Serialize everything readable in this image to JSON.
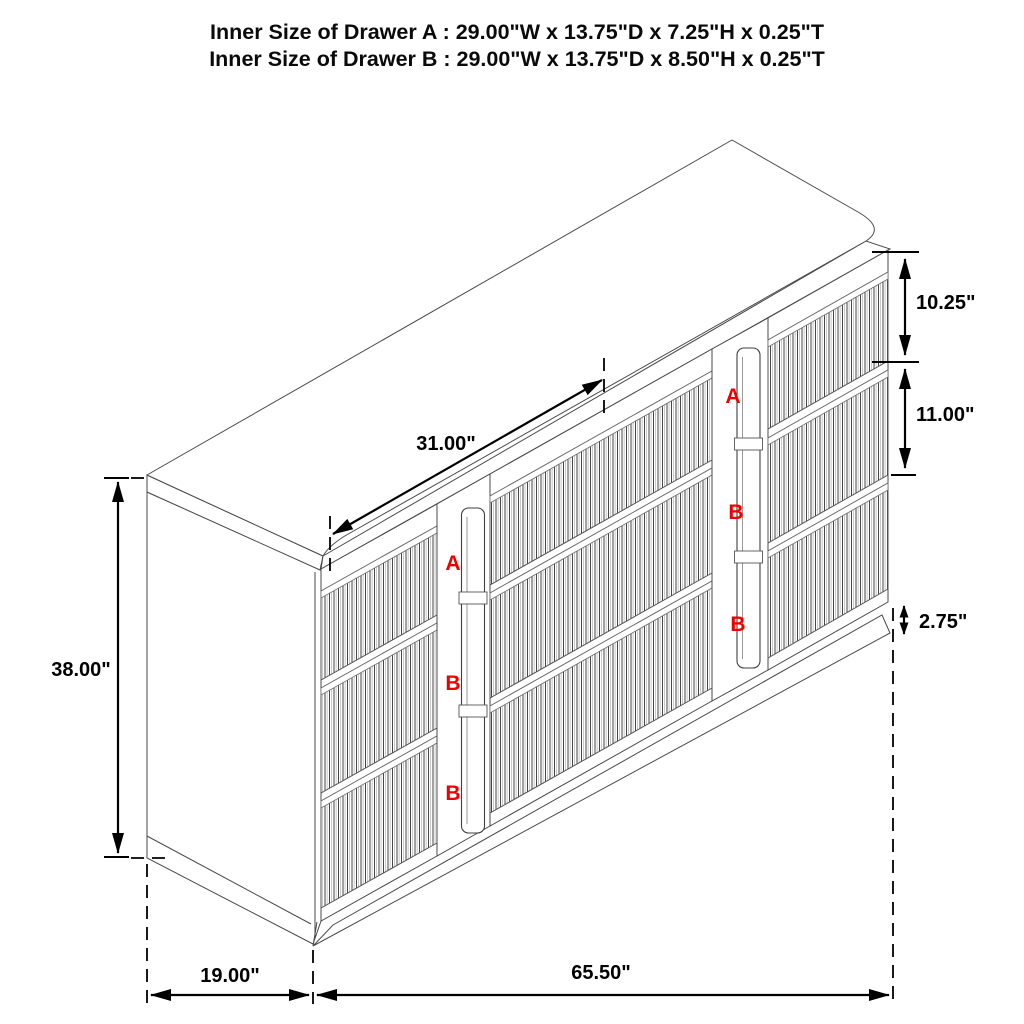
{
  "title": {
    "line1": "Inner Size of Drawer A : 29.00\"W x 13.75\"D x 7.25\"H x 0.25\"T",
    "line2": "Inner Size of Drawer B : 29.00\"W x 13.75\"D x 8.50\"H x 0.25\"T"
  },
  "dimensions": {
    "inner_width": "31.00\"",
    "overall_height": "38.00\"",
    "drawer_a_front_height": "10.25\"",
    "drawer_b_front_height": "11.00\"",
    "base_height": "2.75\"",
    "depth": "19.00\"",
    "overall_width": "65.50\""
  },
  "drawer_letters": {
    "left_column": [
      "A",
      "B",
      "B"
    ],
    "right_column": [
      "A",
      "B",
      "B"
    ]
  },
  "colors": {
    "line": "#000000",
    "cabinet_line": "#4a4a4a",
    "label_red": "#ee0000",
    "background": "#ffffff"
  }
}
